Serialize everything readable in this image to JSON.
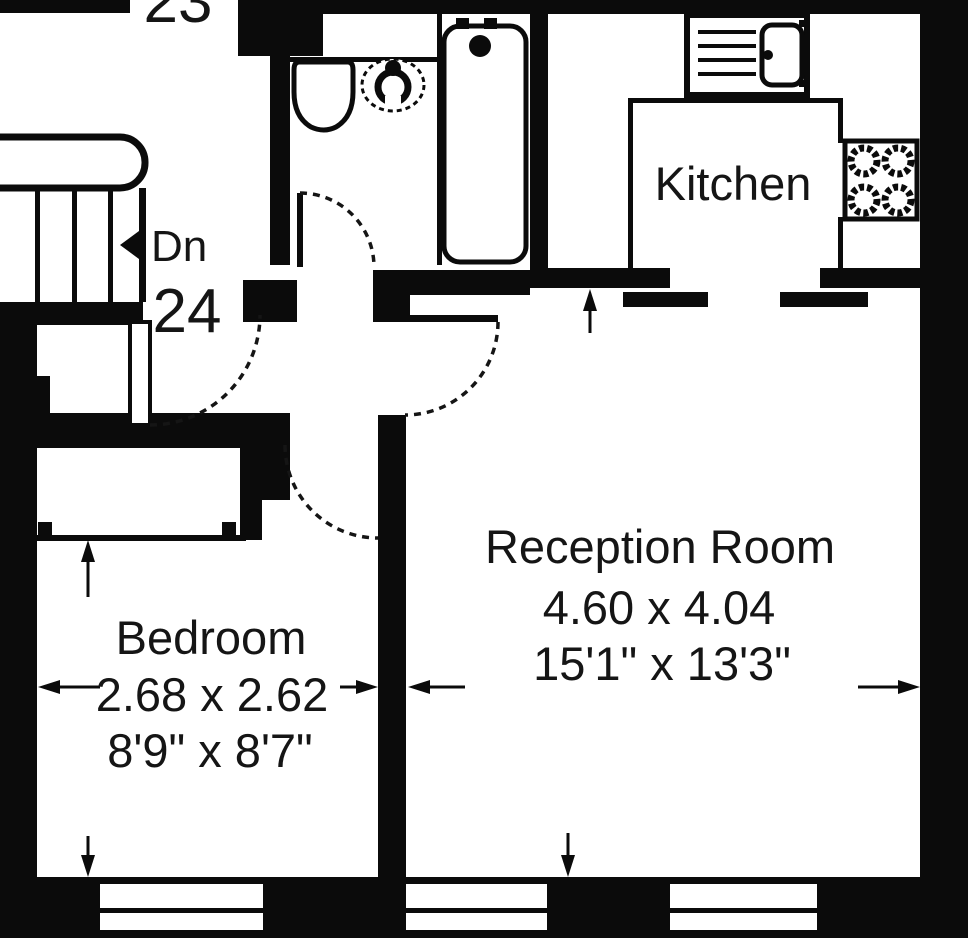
{
  "plan": {
    "flat_numbers": {
      "upper": "23",
      "lower": "24"
    },
    "stairs": {
      "direction_label": "Dn"
    },
    "rooms": {
      "kitchen": {
        "label": "Kitchen"
      },
      "reception": {
        "label": "Reception Room",
        "dims_m": "4.60 x 4.04",
        "dims_ft": "15'1\" x 13'3\""
      },
      "bedroom": {
        "label": "Bedroom",
        "dims_m": "2.68 x 2.62",
        "dims_ft": "8'9\" x 8'7\""
      }
    },
    "colors": {
      "wall": "#0b0b0b",
      "background": "#ffffff",
      "text": "#151515"
    }
  }
}
